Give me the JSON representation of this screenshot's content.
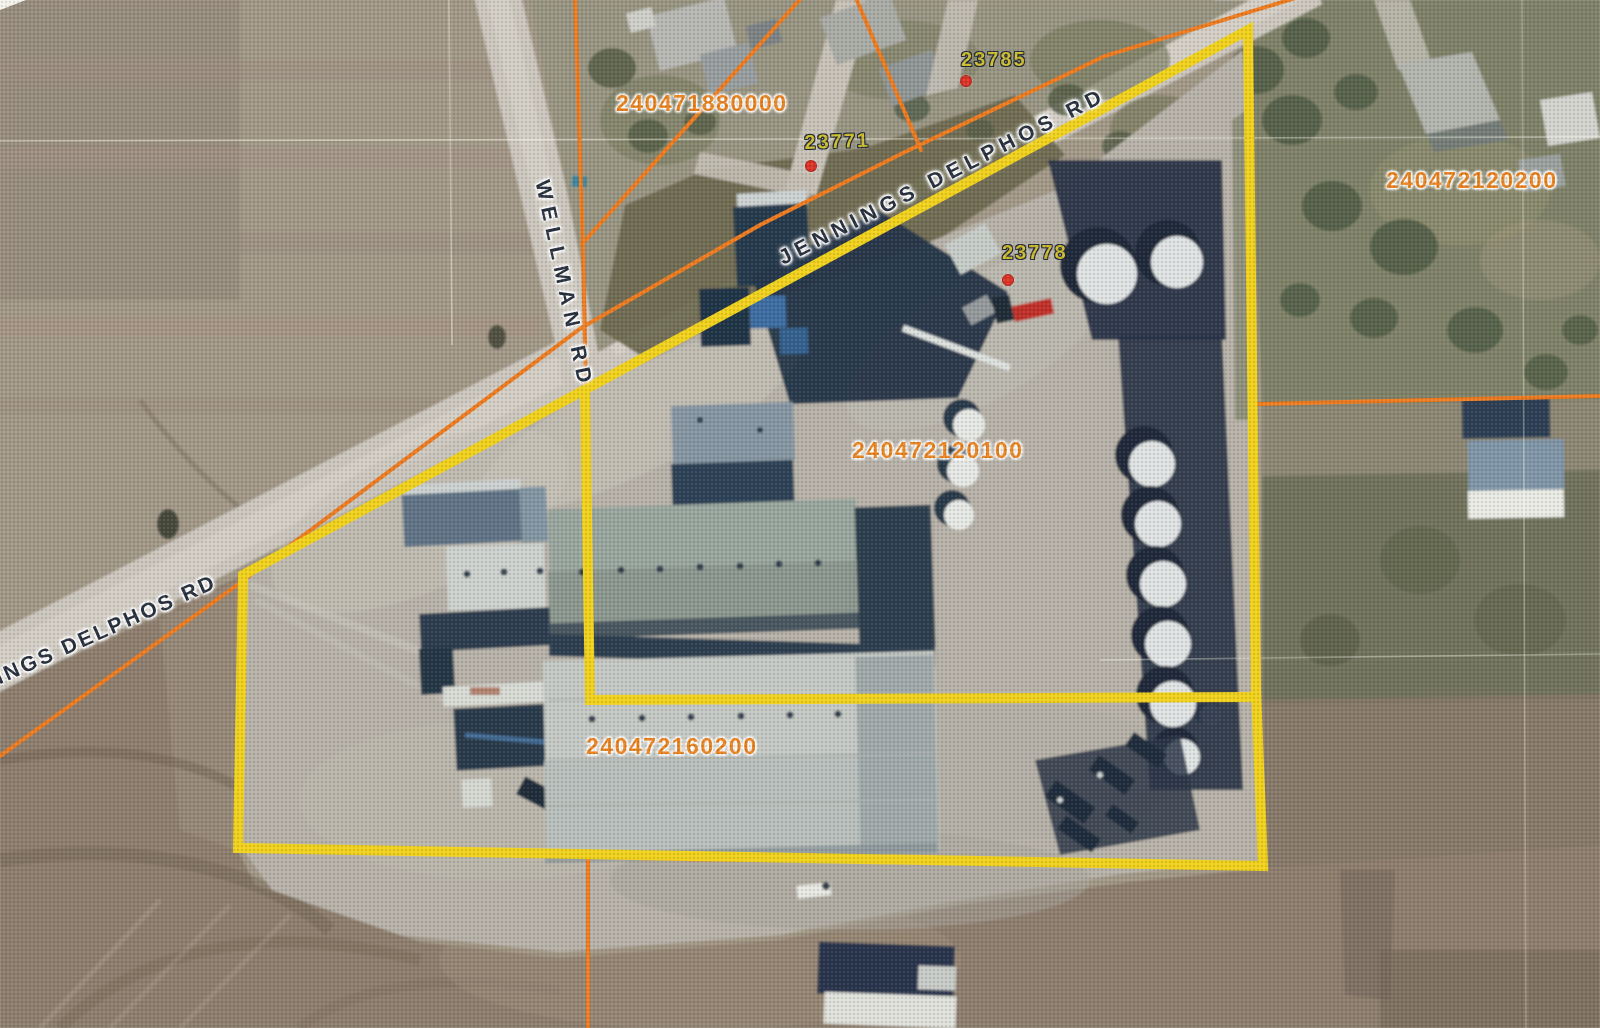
{
  "map": {
    "description": "Scanned aerial parcel map of a grain elevator facility at the Jennings Delphos Rd / Wellman Rd intersection",
    "road_labels": [
      {
        "text": "JENNINGS DELPHOS RD"
      },
      {
        "text": "INGS DELPHOS RD"
      },
      {
        "text": "WELLMAN RD"
      }
    ],
    "parcel_labels": [
      {
        "id": "240471880000"
      },
      {
        "id": "240472120200"
      },
      {
        "id": "240472120100"
      },
      {
        "id": "240472160200"
      }
    ],
    "address_labels": [
      {
        "id": "23785"
      },
      {
        "id": "23771"
      },
      {
        "id": "23778"
      }
    ],
    "overlay": {
      "highlight_color": "#f1d21b",
      "parcel_line_color": "#ee7b1e",
      "parcel_label_color": "#e8821e",
      "address_label_color": "#cfbe2f",
      "address_point_color": "#dd3327",
      "road_label_color": "#252e3c"
    }
  }
}
